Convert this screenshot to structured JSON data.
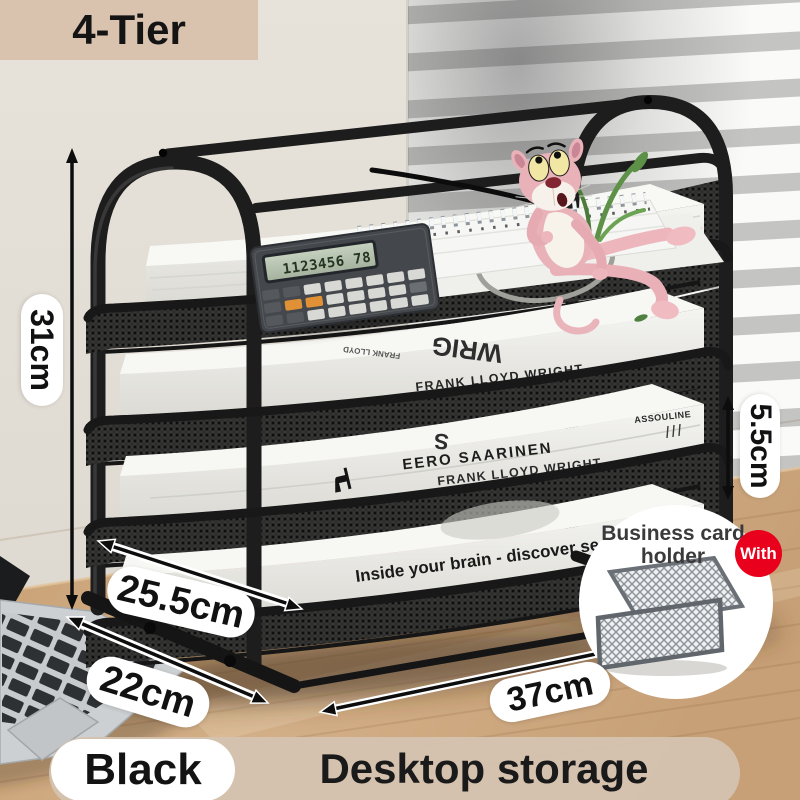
{
  "banner": {
    "label": "4-Tier"
  },
  "dimensions": {
    "height": "31cm",
    "tray_gap": "5.5cm",
    "tray_depth": "25.5cm",
    "base_depth": "22cm",
    "width": "37cm"
  },
  "inset": {
    "title_line1": "Business card",
    "title_line2": "holder",
    "badge_label": "With"
  },
  "footer": {
    "color_label": "Black",
    "category_label": "Desktop storage"
  },
  "books": {
    "tier2_top_large": "WRIG",
    "tier2_top_small": "FRANK LLOYD",
    "tier2_spine": "FRANK LLOYD WRIGHT",
    "tier3_top": "S",
    "tier3_author": "EERO SAARINEN",
    "tier3_spine": "FRANK LLOYD WRIGHT",
    "tier3_publisher": "ASSOULINE",
    "tier4_title": "Inside your brain - discover se"
  },
  "props": {
    "calculator_display": "1123456 78"
  },
  "colors": {
    "accent_red": "#e8001c",
    "frame_black": "#1c1c1c",
    "banner_bg": "#dac3ae",
    "footer_bar_bg": "#d4c2b0",
    "desk_wood": "#cda87f",
    "wall": "#e2ded6"
  }
}
